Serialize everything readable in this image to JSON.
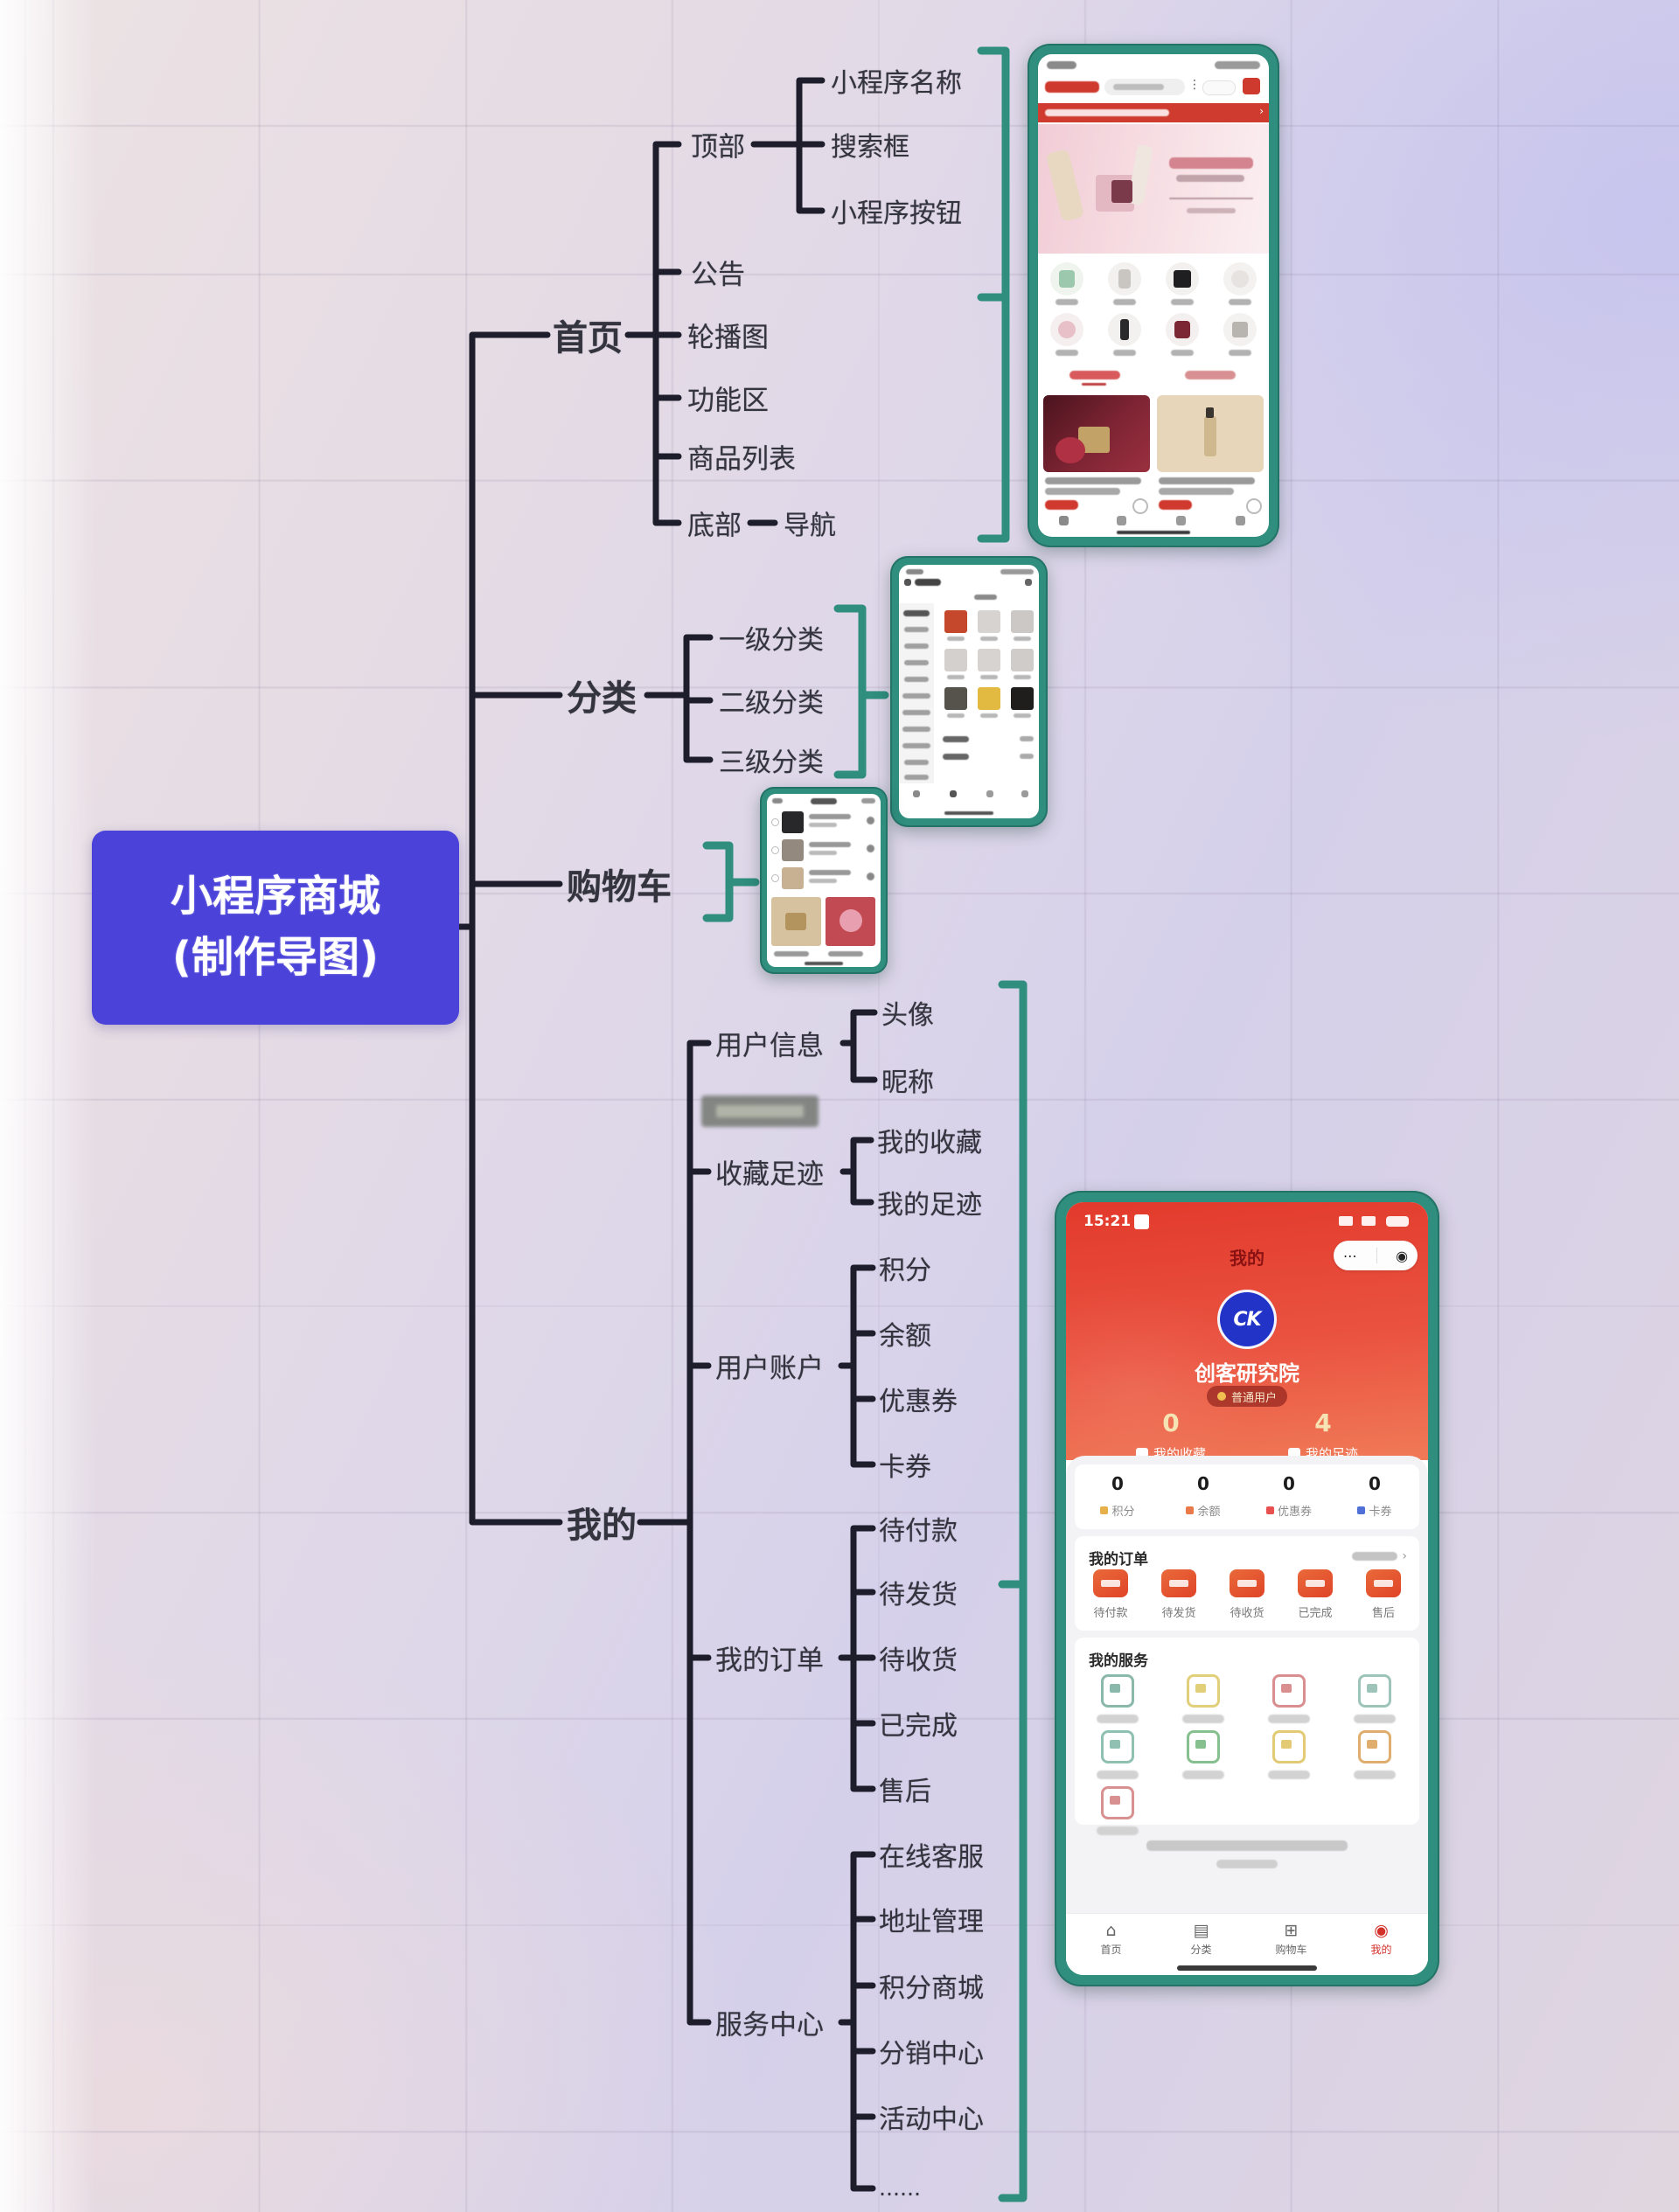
{
  "mindmap": {
    "root": {
      "line1": "小程序商城",
      "line2": "(制作导图)"
    },
    "home": {
      "label": "首页",
      "top": {
        "label": "顶部",
        "children": [
          "小程序名称",
          "搜索框",
          "小程序按钮"
        ]
      },
      "announcement": "公告",
      "carousel": "轮播图",
      "function_area": "功能区",
      "product_list": "商品列表",
      "bottom": {
        "label": "底部",
        "child": "导航"
      }
    },
    "category": {
      "label": "分类",
      "children": [
        "一级分类",
        "二级分类",
        "三级分类"
      ]
    },
    "cart": {
      "label": "购物车"
    },
    "mine": {
      "label": "我的",
      "user_info": {
        "label": "用户信息",
        "children": [
          "头像",
          "昵称"
        ]
      },
      "footprints": {
        "label": "收藏足迹",
        "children": [
          "我的收藏",
          "我的足迹"
        ]
      },
      "account": {
        "label": "用户账户",
        "children": [
          "积分",
          "余额",
          "优惠券",
          "卡券"
        ]
      },
      "orders": {
        "label": "我的订单",
        "children": [
          "待付款",
          "待发货",
          "待收货",
          "已完成",
          "售后"
        ]
      },
      "service": {
        "label": "服务中心",
        "children": [
          "在线客服",
          "地址管理",
          "积分商城",
          "分销中心",
          "活动中心",
          "……"
        ]
      }
    }
  },
  "profile_phone": {
    "status_time": "15:21",
    "nav_title": "我的",
    "avatar_logo": "CK",
    "username": "创客研究院",
    "badge": "普通用户",
    "favorites": {
      "value": "0",
      "label": "我的收藏"
    },
    "footprints": {
      "value": "4",
      "label": "我的足迹"
    },
    "account_stats": [
      {
        "value": "0",
        "label": "积分"
      },
      {
        "value": "0",
        "label": "余额"
      },
      {
        "value": "0",
        "label": "优惠券"
      },
      {
        "value": "0",
        "label": "卡券"
      }
    ],
    "orders_title": "我的订单",
    "order_items": [
      "待付款",
      "待发货",
      "待收货",
      "已完成",
      "售后"
    ],
    "services_title": "我的服务",
    "tabs": [
      "首页",
      "分类",
      "购物车",
      "我的"
    ],
    "capsule_dots": "⋯",
    "capsule_target": "◉",
    "more_chevron": "›"
  },
  "colors": {
    "accent_teal": "#2f8e7e",
    "root_blue": "#4a42d9",
    "profile_red": "#e8432f",
    "announce_red": "#cf3b2f"
  }
}
